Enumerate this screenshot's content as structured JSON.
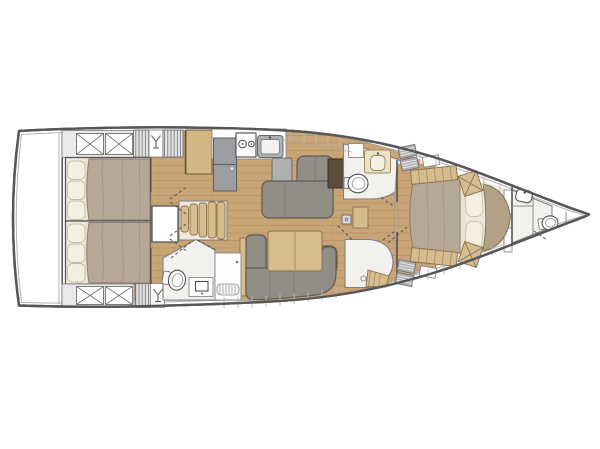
{
  "figure": {
    "type": "sailing-yacht-interior-floor-plan",
    "view": "top-down",
    "orientation": {
      "bow": "right",
      "stern": "left"
    }
  },
  "palette": {
    "hull_line": "#575757",
    "hull_inner": "#b3b3b3",
    "deck": "#ffffff",
    "sole": "#c9a476",
    "plank": "#a07c48",
    "wood_light": "#d7bc8d",
    "wood_cab": "#d3b586",
    "sofa": "#918e85",
    "sofa_dark": "#5e5c54",
    "cushion": "#8e8b83",
    "appliance": "#9b9da0",
    "steel": "#aeb0b2",
    "duvet": "#b5a897",
    "duvet_line": "#8a7f70",
    "pillow": "#f4efe1",
    "sheet": "#e9e2d4",
    "headboard": "#b2a187",
    "counter_cream": "#ece1c4",
    "chart_table": "#5d4d3f",
    "head_floor": "#f2f1ee",
    "cabin_gray": "#e9e9eb",
    "hatch_gray": "#b1b1b4",
    "fixture_white": "#fdfdfd",
    "line_mid": "#8a8a8a"
  },
  "rooms": [
    {
      "id": "hull",
      "label": "Hull outline, bow to the right"
    },
    {
      "id": "aft-port-cabin",
      "label": "Aft cabin port with double berth",
      "features": [
        "double-berth",
        "pillows",
        "storage-hatches",
        "louvered-lockers",
        "glassware-locker"
      ]
    },
    {
      "id": "aft-starboard-cabin",
      "label": "Aft cabin starboard with double berth",
      "features": [
        "double-berth",
        "pillows",
        "storage-hatches",
        "louvered-locker",
        "wet-locker"
      ]
    },
    {
      "id": "galley",
      "label": "Galley",
      "features": [
        "storage-cabinet",
        "refrigerator",
        "two-burner-stove",
        "sink",
        "counter"
      ]
    },
    {
      "id": "salon",
      "label": "Salon",
      "features": [
        "l-shaped-settee",
        "dining-table",
        "sofa",
        "chart-table"
      ]
    },
    {
      "id": "companionway",
      "label": "Companionway",
      "features": [
        "curved-steps",
        "mast-step-hatch"
      ]
    },
    {
      "id": "aft-head",
      "label": "Aft head",
      "features": [
        "toilet",
        "washbasin",
        "vanity",
        "louvered-vent"
      ]
    },
    {
      "id": "day-head",
      "label": "Forward day head",
      "features": [
        "toilet",
        "washbasin",
        "vanity",
        "locker"
      ]
    },
    {
      "id": "owner-shower",
      "label": "Owner shower room",
      "features": [
        "shower-bench",
        "drain"
      ]
    },
    {
      "id": "owner-cabin",
      "label": "Owner cabin with island berth",
      "features": [
        "island-berth",
        "pillows",
        "headboard",
        "side-benches",
        "deck-hatches"
      ]
    },
    {
      "id": "bow-head",
      "label": "Bow head",
      "features": [
        "toilet",
        "washbasin",
        "shelves"
      ]
    }
  ],
  "fixture_counts": {
    "berths": 3,
    "toilets": 3,
    "sinks_heads": 3,
    "stove_burners": 2,
    "stairs_treads": 5
  }
}
